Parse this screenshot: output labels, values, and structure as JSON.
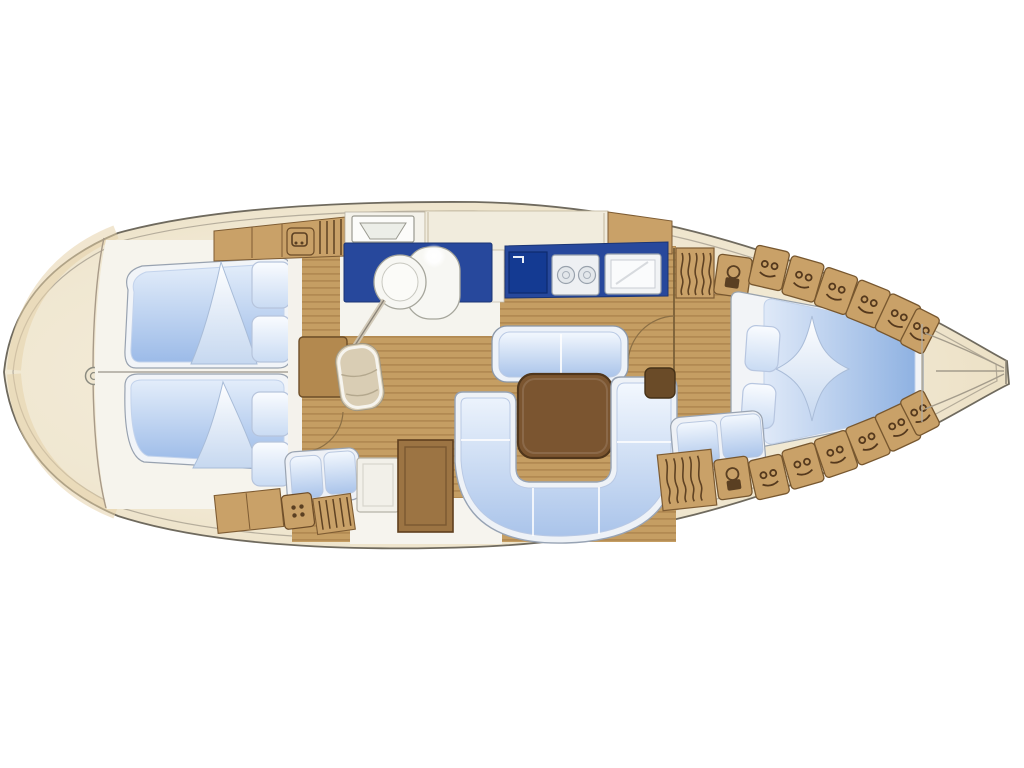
{
  "diagram": {
    "type": "sailing-yacht-interior-floor-plan",
    "orientation": {
      "bow": "left",
      "stern": "right",
      "view": "top-down deck plan"
    },
    "colors": {
      "background": "#ffffff",
      "hull_fill": "#f0e7d1",
      "hull_edge": "#6f6a5e",
      "deck_shade": "#e5d2a9",
      "wood_floor": "#c59e63",
      "plank_line": "#a97f49",
      "cabinet_wood": "#c9a168",
      "cabinet_edge": "#7e5c33",
      "counter_navy": "#27489c",
      "sink_navy": "#143a92",
      "cushion_blue": "#b7cdec",
      "cushion_light": "#f3f8fe",
      "mattress_white": "#f2f4f7",
      "table_brown": "#7b5530",
      "fixture_white": "#f6f6f2",
      "dark_wood": "#6a4b28"
    },
    "areas": [
      {
        "id": "hull",
        "label": "Yacht hull deck plan, bow left, stern right"
      },
      {
        "id": "anchor-locker",
        "label": "Bow anchor locker"
      },
      {
        "id": "windlass",
        "label": "Windlass fitting"
      },
      {
        "id": "forward-cabin",
        "label": "Forward cabin"
      },
      {
        "id": "v-berth-upper",
        "label": "Forward V-berth, upper"
      },
      {
        "id": "v-berth-lower",
        "label": "Forward V-berth, lower"
      },
      {
        "id": "forward-lockers-upper",
        "label": "Forward cabin lockers, upper"
      },
      {
        "id": "forward-lockers-lower",
        "label": "Forward cabin lockers, lower"
      },
      {
        "id": "head",
        "label": "Head compartment with navy counter"
      },
      {
        "id": "washbasin",
        "label": "Washbasin"
      },
      {
        "id": "toilet",
        "label": "Toilet"
      },
      {
        "id": "head-door",
        "label": "Open head door"
      },
      {
        "id": "nav-desk",
        "label": "Desk"
      },
      {
        "id": "nav-seat",
        "label": "Seat"
      },
      {
        "id": "galley",
        "label": "Galley counter"
      },
      {
        "id": "galley-sink",
        "label": "Galley sink"
      },
      {
        "id": "stove",
        "label": "Two-burner stove"
      },
      {
        "id": "oven",
        "label": "Oven / icebox"
      },
      {
        "id": "companionway",
        "label": "Companionway steps"
      },
      {
        "id": "salon-bench",
        "label": "Salon bench seat"
      },
      {
        "id": "salon-table",
        "label": "Salon table"
      },
      {
        "id": "u-settee",
        "label": "U-shaped settee"
      },
      {
        "id": "side-settee",
        "label": "Side settee"
      },
      {
        "id": "cabinets",
        "label": "Storage cabinets"
      },
      {
        "id": "aft-berth",
        "label": "Aft double berth"
      },
      {
        "id": "aft-seat",
        "label": "Aft seat with two cushions"
      },
      {
        "id": "lockers-upper",
        "label": "Cockpit side lockers, upper row"
      },
      {
        "id": "lockers-lower",
        "label": "Cockpit side lockers, lower row"
      },
      {
        "id": "stern",
        "label": "Stern / transom"
      }
    ]
  }
}
